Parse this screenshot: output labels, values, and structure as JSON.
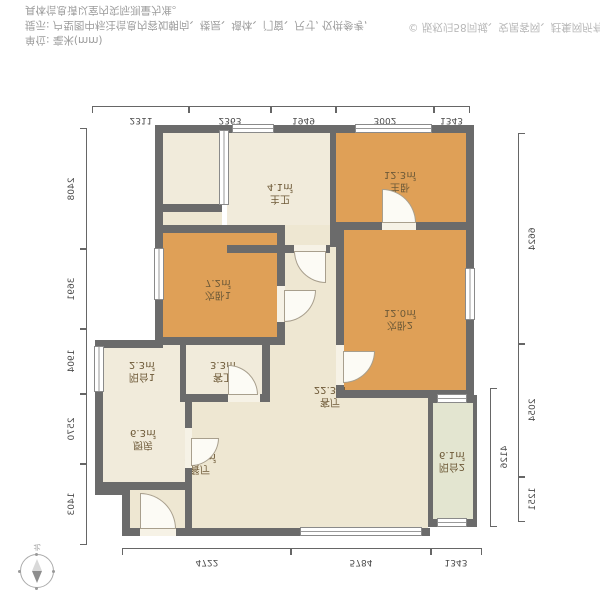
{
  "footer": {
    "unit_line": "单位: 毫米(mm)",
    "tip_line1": "提示: 户型图中标注信息内容如朝向、楼层、墙体、门窗、尺寸, 仅供参考,",
    "tip_line2": "具体信息请以室内实际测量为准。",
    "copyright": "© 版权归58同城、安居客网、赶集网所有"
  },
  "compass": {
    "label": "北"
  },
  "palette": {
    "wall": "#6b6b6b",
    "bedroom_fill": "#dfa057",
    "bath_fill": "#f1ebdb",
    "hall_fill": "#eee7d2",
    "balcony_fill": "#e3e5d0"
  },
  "rooms": [
    {
      "name": "主卧",
      "area": "12.3㎡"
    },
    {
      "name": "主卫",
      "area": "4.1㎡"
    },
    {
      "name": "次卧1",
      "area": "7.2㎡"
    },
    {
      "name": "次卧2",
      "area": "12.0㎡"
    },
    {
      "name": "客厅",
      "area": "22.3㎡"
    },
    {
      "name": "餐厅",
      "area": "11.3㎡"
    },
    {
      "name": "客卫",
      "area": "3.3㎡"
    },
    {
      "name": "阳台1",
      "area": "2.3㎡"
    },
    {
      "name": "厨房",
      "area": "6.3㎡"
    },
    {
      "name": "阳台2",
      "area": "6.1㎡"
    }
  ],
  "dims": {
    "top": [
      "4722",
      "5784",
      "1343"
    ],
    "bottom": [
      "2311",
      "2363",
      "1949",
      "3002",
      "1343"
    ],
    "left": [
      "1403",
      "2570",
      "1904",
      "3691",
      "2408"
    ],
    "right": [
      "1251",
      "2054",
      "6624"
    ],
    "right_inner": "4126"
  }
}
